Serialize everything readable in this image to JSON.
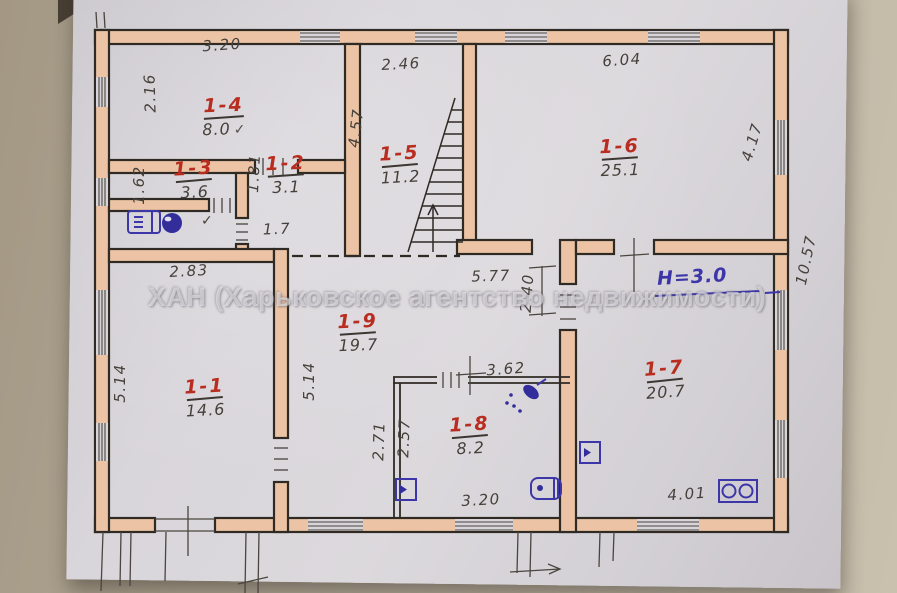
{
  "watermark": "ХАН (Харьковское агентство недвижимости)",
  "height_note": "Н=3.0",
  "bath_check": "✓",
  "rooms": [
    {
      "number": "1-4",
      "area": "8.0",
      "check": "✓"
    },
    {
      "number": "1-3",
      "area": "3.6",
      "check": ""
    },
    {
      "number": "1-2",
      "area": "3.1",
      "check": ""
    },
    {
      "number": "1-5",
      "area": "11.2",
      "check": ""
    },
    {
      "number": "1-6",
      "area": "25.1",
      "check": ""
    },
    {
      "number": "1-1",
      "area": "14.6",
      "check": ""
    },
    {
      "number": "1-9",
      "area": "19.7",
      "check": ""
    },
    {
      "number": "1-8",
      "area": "8.2",
      "check": ""
    },
    {
      "number": "1-7",
      "area": "20.7",
      "check": ""
    }
  ],
  "dims": {
    "room4_top": "3.20",
    "room5_top": "2.46",
    "room6_top": "6.04",
    "room4_left": "2.16",
    "room3_left": "1.62",
    "stairs_left": "4.57",
    "room6_right": "4.17",
    "building_right": "10.57",
    "room2_left": "1.81",
    "room2_bottom": "1.7",
    "room1_top": "2.83",
    "room1_left": "5.14",
    "room1_right": "5.14",
    "hall_top": "5.77",
    "hall_door": "2.40",
    "room8_top": "3.62",
    "room8_left": "2.71",
    "room8_inner": "2.57",
    "room8_bottom": "3.20",
    "room7_bottom": "4.01"
  },
  "icons": {
    "washing_machine": "washing-machine-icon",
    "sink": "sink-icon",
    "shower": "shower-icon",
    "vent_bath": "vent-icon",
    "water_heater": "water-heater-icon",
    "vent_hall": "vent-icon",
    "stove": "stove-icon"
  },
  "colors": {
    "wall_fill": "#ecc3a4",
    "ink": "#2f2a24",
    "red_label": "#b92d20",
    "blue_note": "#3c36a8",
    "pencil": "#45403a",
    "paper": "#d8d5da"
  }
}
